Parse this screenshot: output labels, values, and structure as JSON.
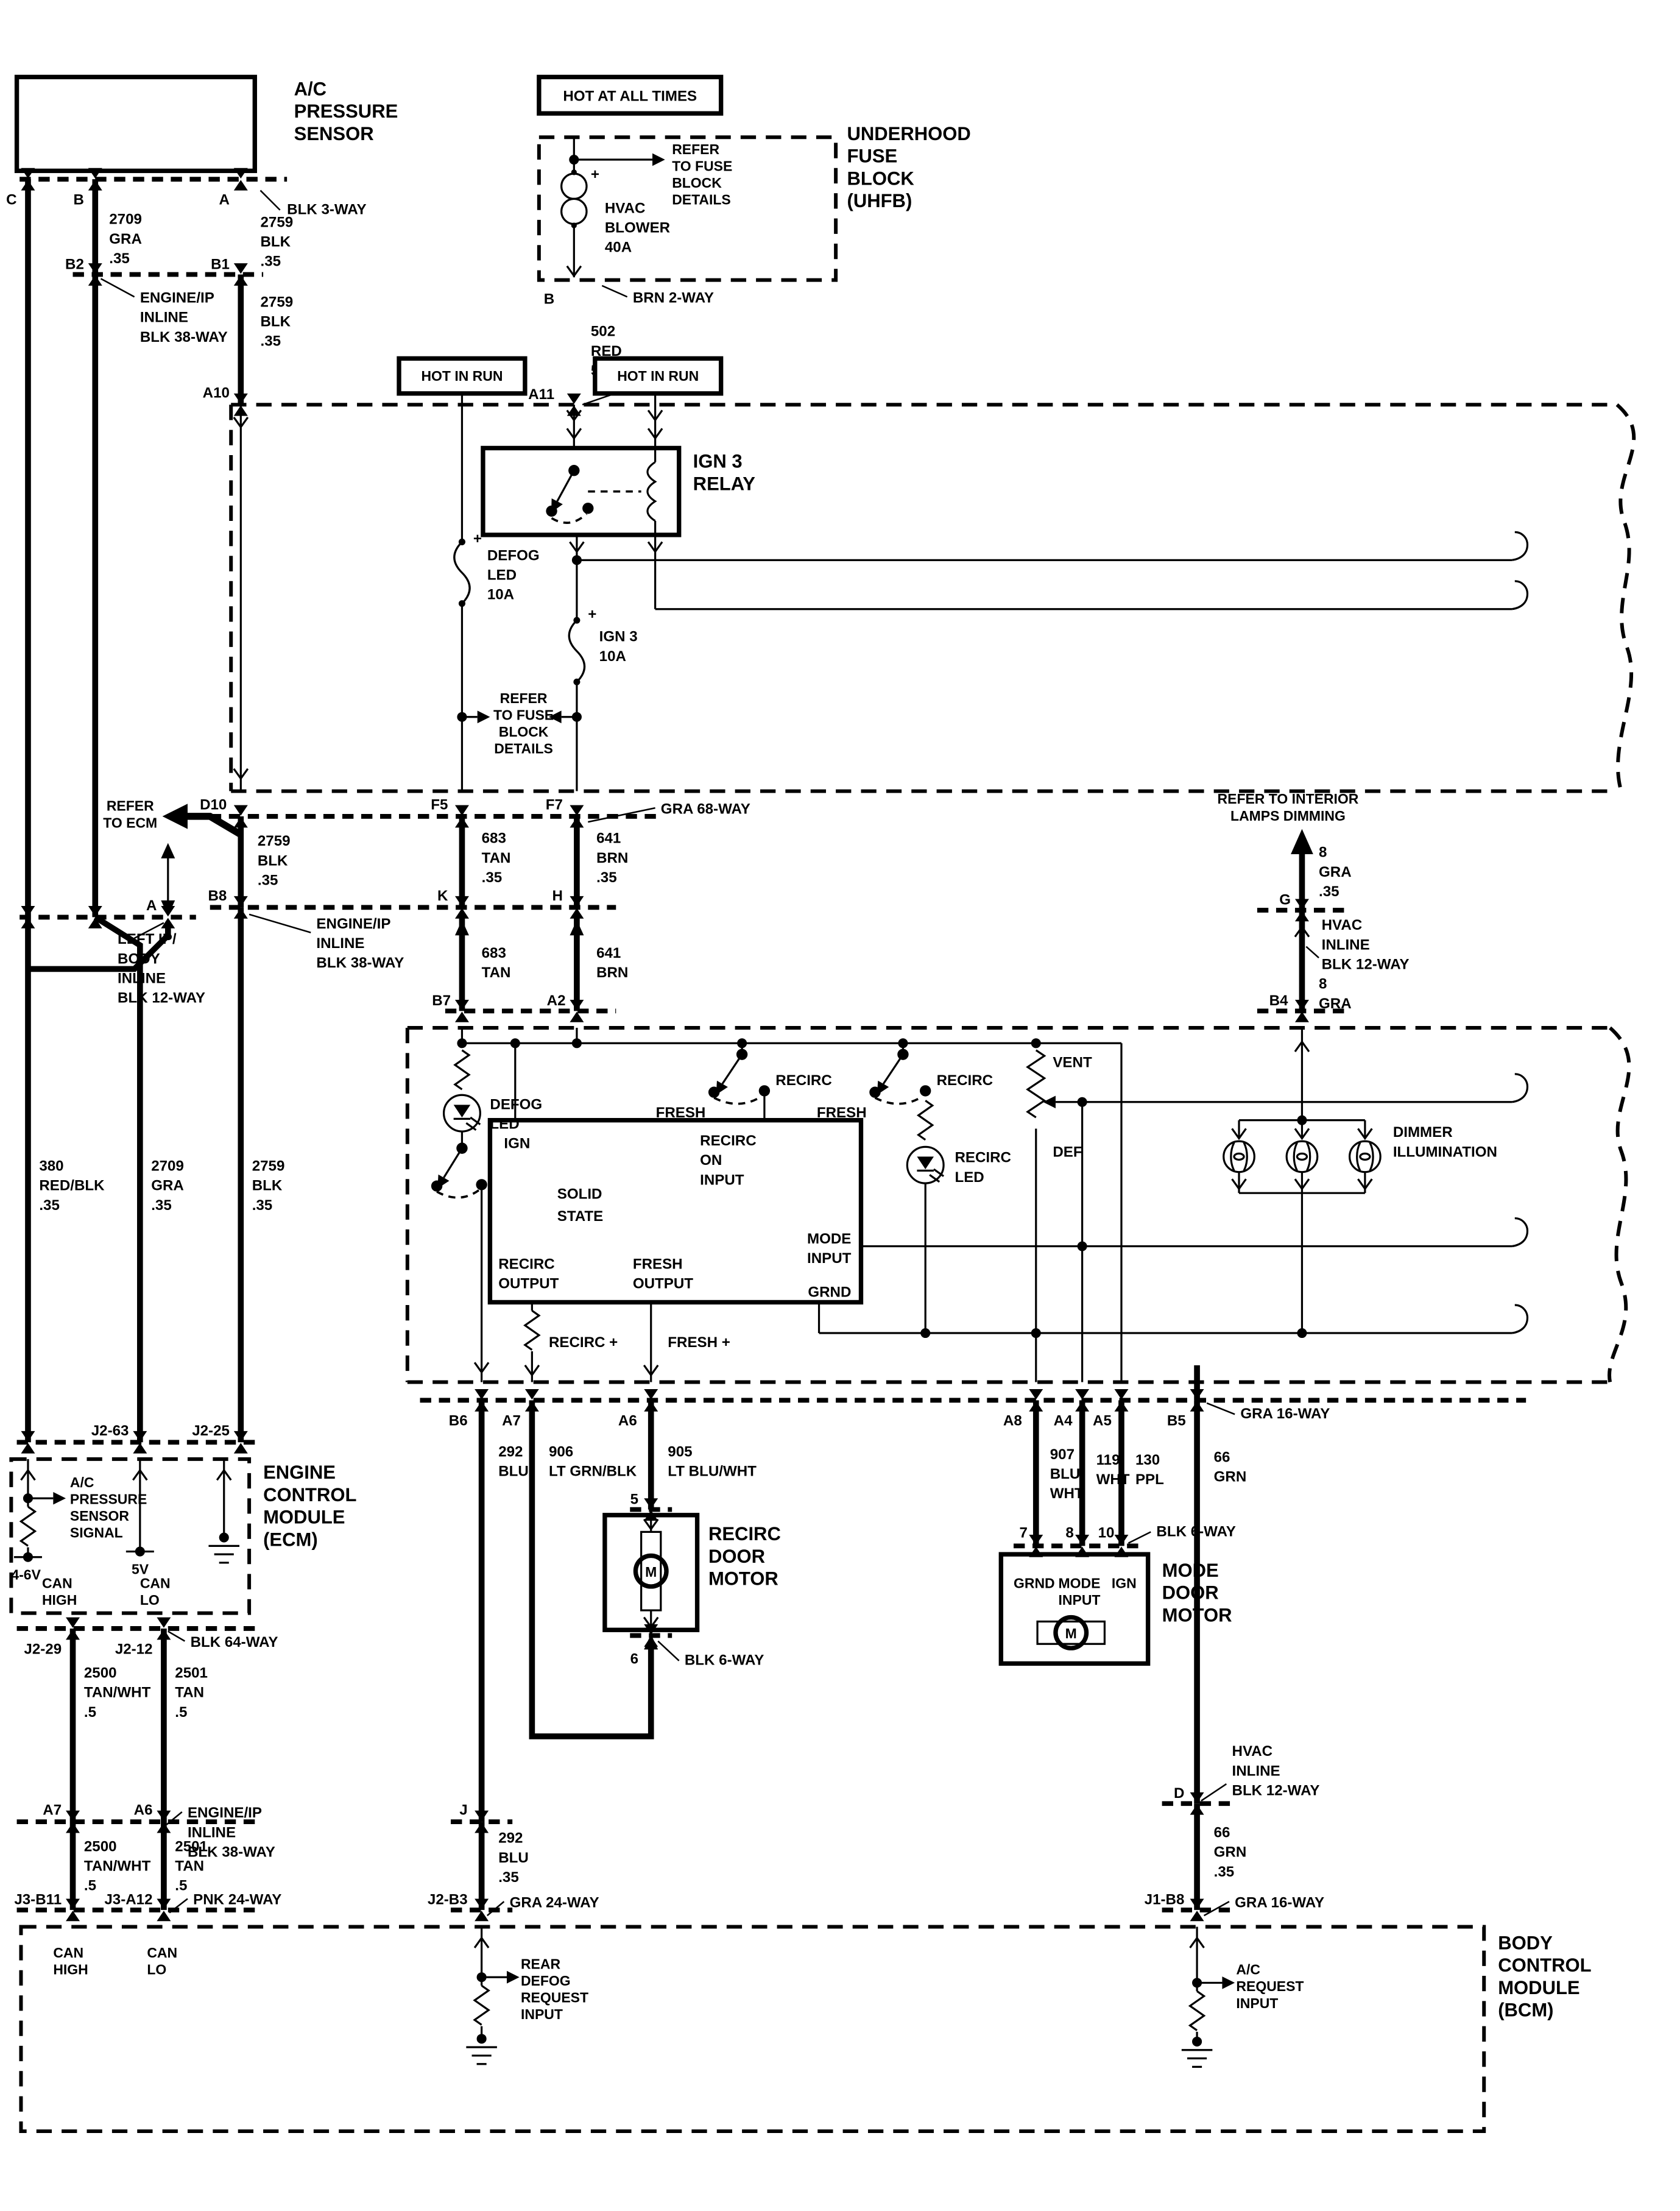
{
  "diagram_type": "automotive wiring schematic - HVAC / A/C pressure sensor circuit",
  "labels": {
    "acps": [
      "A/C",
      "PRESSURE",
      "SENSOR"
    ],
    "hot_all": "HOT AT ALL TIMES",
    "hot_run": "HOT IN RUN",
    "refuse": [
      "REFER",
      "TO FUSE",
      "BLOCK",
      "DETAILS"
    ],
    "hvac_blower": [
      "HVAC",
      "BLOWER",
      "40A"
    ],
    "uhfb": [
      "UNDERHOOD",
      "FUSE",
      "BLOCK",
      "(UHFB)"
    ],
    "relay": [
      "IGN 3",
      "RELAY"
    ],
    "fuse_defog": [
      "DEFOG",
      "LED",
      "10A"
    ],
    "fuse_ign3": [
      "IGN 3",
      "10A"
    ],
    "ref_ecm": [
      "REFER",
      "TO ECM"
    ],
    "ref_interior": [
      "REFER TO INTERIOR",
      "LAMPS DIMMING"
    ],
    "pins": {
      "c": "C",
      "b": "B",
      "a": "A",
      "b2": "B2",
      "b1": "B1",
      "a10": "A10",
      "a11": "A11",
      "b_uhfb": "B",
      "d10": "D10",
      "f5": "F5",
      "f7": "F7",
      "k": "K",
      "h": "H",
      "b8": "B8",
      "a_pin": "A",
      "g": "G",
      "b7": "B7",
      "a2": "A2",
      "b4": "B4",
      "b6": "B6",
      "a7": "A7",
      "a6": "A6",
      "a8": "A8",
      "a4": "A4",
      "a5": "A5",
      "b5": "B5",
      "j": "J",
      "j2b3": "J2-B3",
      "d": "D",
      "j1b8": "J1-B8",
      "j263": "J2-63",
      "j225": "J2-25",
      "j229": "J2-29",
      "j212": "J2-12",
      "j3b11": "J3-B11",
      "j3a12": "J3-A12",
      "p5": "5",
      "p6": "6",
      "p7": "7",
      "p8": "8",
      "p10": "10"
    },
    "wires": {
      "w2709": [
        "2709",
        "GRA",
        ".35"
      ],
      "w2759": [
        "2759",
        "BLK",
        ".35"
      ],
      "blk3": "BLK 3-WAY",
      "eng38": [
        "ENGINE/IP",
        "INLINE",
        "BLK 38-WAY"
      ],
      "left12": [
        "LEFT IP/",
        "BODY",
        "INLINE",
        "BLK 12-WAY"
      ],
      "brn2": "BRN 2-WAY",
      "w502": [
        "502",
        "RED",
        "5.0"
      ],
      "gra68": "GRA 68-WAY",
      "w683a": [
        "683",
        "TAN",
        ".35"
      ],
      "w641a": [
        "641",
        "BRN",
        ".35"
      ],
      "w683b": [
        "683",
        "TAN"
      ],
      "w641b": [
        "641",
        "BRN"
      ],
      "w8graa": [
        "8",
        "GRA",
        ".35"
      ],
      "w8grab": [
        "8",
        "GRA"
      ],
      "hvac12": [
        "HVAC",
        "INLINE",
        "BLK 12-WAY"
      ],
      "w380": [
        "380",
        "RED/BLK",
        ".35"
      ],
      "w292a": [
        "292",
        "BLU"
      ],
      "w292b": [
        "292",
        "BLU",
        ".35"
      ],
      "w906": [
        "906",
        "LT GRN/BLK"
      ],
      "w905": [
        "905",
        "LT BLU/WHT"
      ],
      "w907": [
        "907",
        "BLU/",
        "WHT"
      ],
      "w119": [
        "119",
        "WHT"
      ],
      "w130": [
        "130",
        "PPL"
      ],
      "w66a": [
        "66",
        "GRN"
      ],
      "w66b": [
        "66",
        "GRN",
        ".35"
      ],
      "gra24": "GRA 24-WAY",
      "gra16": "GRA 16-WAY",
      "blk64": "BLK 64-WAY",
      "blk6": "BLK 6-WAY",
      "pnk24": "PNK 24-WAY",
      "w2500": [
        "2500",
        "TAN/WHT",
        ".5"
      ],
      "w2501": [
        "2501",
        "TAN",
        ".5"
      ]
    },
    "ctrl": {
      "defog_led": [
        "DEFOG",
        "LED"
      ],
      "recirc_led": [
        "RECIRC",
        "LED"
      ],
      "recirc": "RECIRC",
      "fresh": "FRESH",
      "ign": "IGN",
      "solid": [
        "SOLID",
        "STATE"
      ],
      "recirc_on": [
        "RECIRC",
        "ON",
        "INPUT"
      ],
      "mode_in": [
        "MODE",
        "INPUT"
      ],
      "grnd": "GRND",
      "recirc_out": [
        "RECIRC",
        "OUTPUT"
      ],
      "fresh_out": [
        "FRESH",
        "OUTPUT"
      ],
      "vent": "VENT",
      "def": "DEF",
      "dimmer": [
        "DIMMER",
        "ILLUMINATION"
      ],
      "recirc_p": "RECIRC +",
      "fresh_p": "FRESH +"
    },
    "motors": {
      "recirc": [
        "RECIRC",
        "DOOR",
        "MOTOR"
      ],
      "mode": [
        "MODE",
        "DOOR",
        "MOTOR"
      ],
      "m": "M"
    },
    "ecm": {
      "name": [
        "ENGINE",
        "CONTROL",
        "MODULE",
        "(ECM)"
      ],
      "acsig": [
        "A/C",
        "PRESSURE",
        "SENSOR",
        "SIGNAL"
      ],
      "v46": "4-6V",
      "v5": "5V",
      "can_high": [
        "CAN",
        "HIGH"
      ],
      "can_lo": [
        "CAN",
        "LO"
      ]
    },
    "bcm": {
      "name": [
        "BODY",
        "CONTROL",
        "MODULE",
        "(BCM)"
      ],
      "rear": [
        "REAR",
        "DEFOG",
        "REQUEST",
        "INPUT"
      ],
      "acreq": [
        "A/C",
        "REQUEST",
        "INPUT"
      ]
    },
    "plus": "+"
  }
}
